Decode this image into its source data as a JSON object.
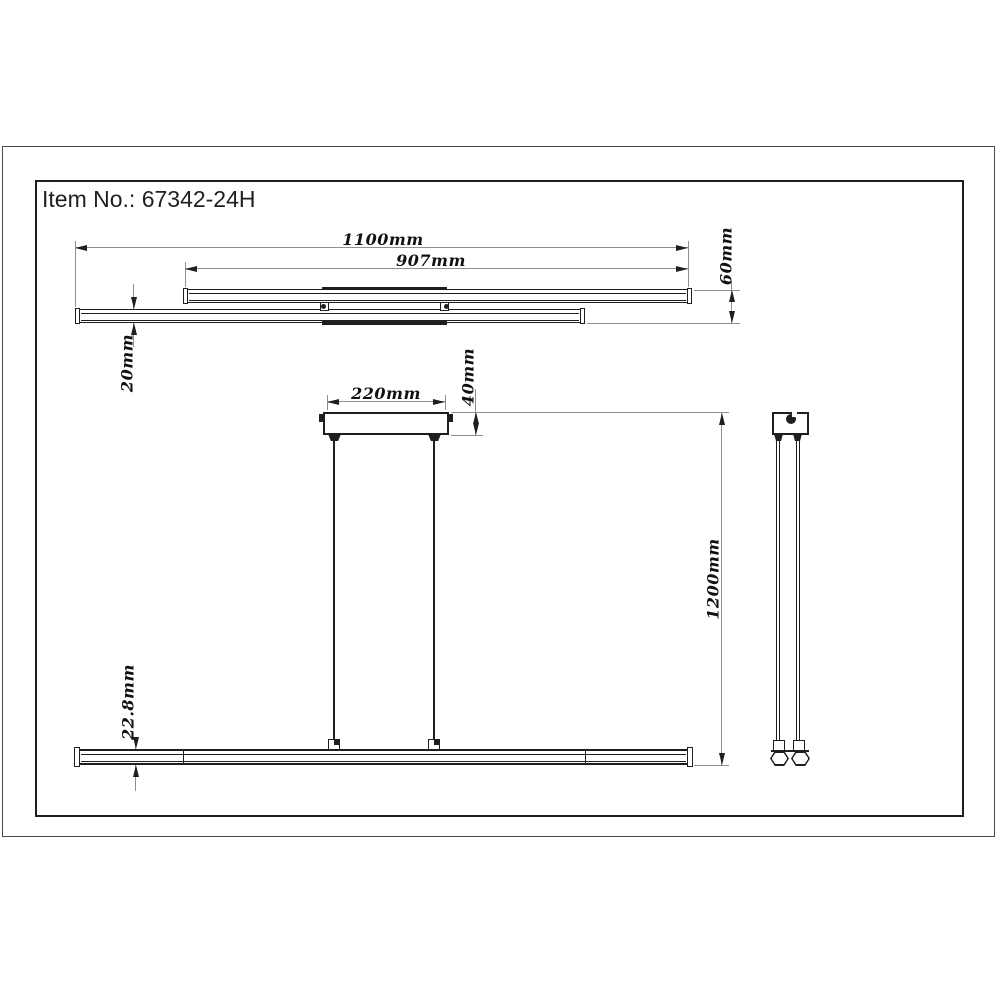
{
  "title": "Item No.: 67342-24H",
  "drawing": {
    "top_view": {
      "dims": {
        "total_length": "1100mm",
        "upper_bar_length": "907mm",
        "stack_height": "60mm",
        "bar_thickness": "20mm"
      }
    },
    "front_view": {
      "dims": {
        "canopy_width": "220mm",
        "canopy_height": "40mm",
        "suspension_drop": "1200mm",
        "bar_profile_height": "22.8mm"
      }
    }
  },
  "colors": {
    "object_line": "#1f1f1f",
    "dimension_line": "#8f8f8f",
    "label_text": "#111111",
    "background": "#ffffff"
  }
}
